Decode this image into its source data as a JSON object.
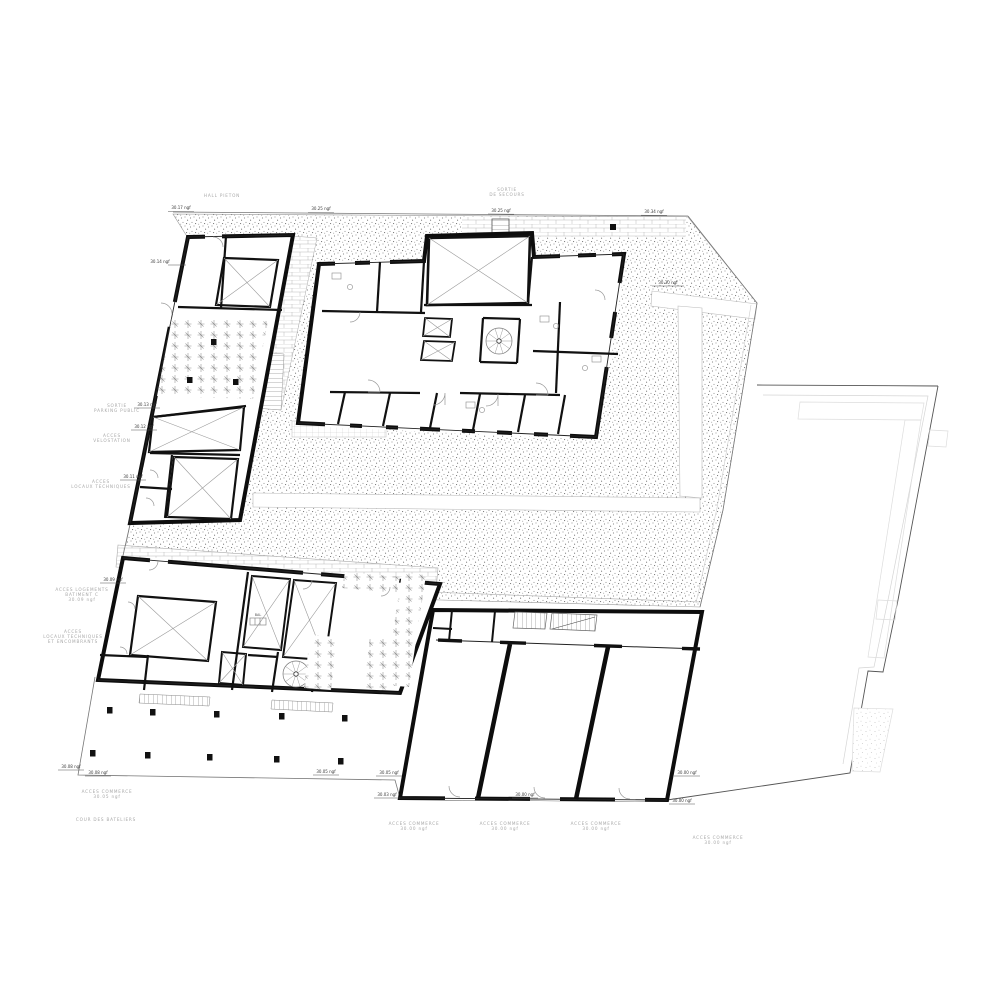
{
  "drawing": {
    "type": "architectural-floor-plan",
    "level": "ground-floor",
    "colors": {
      "wall": "#111111",
      "thin_line": "#888888",
      "light_line": "#cccccc",
      "label_gray": "#a8a8a8",
      "label_black": "#3a3a3a",
      "paper": "#ffffff"
    }
  },
  "labels": {
    "e1": "30.17 ngf",
    "e2": "30.25 ngf",
    "e3": "30.25 ngf",
    "e4": "30.34 ngf",
    "e5": "30.30 ngf",
    "e6": "30.14 ngf",
    "e7": "30.13 ngf",
    "e8": "30.12 ngf",
    "e9": "30.11 ngf",
    "e10": "30.09 ngf",
    "e11": "30.08 ngf",
    "e12": "30.08 ngf",
    "e13": "30.05 ngf",
    "e14": "30.05 ngf",
    "e15": "30.03 ngf",
    "e16": "30.00 ngf",
    "e17": "30.00 ngf",
    "e18": "30.00 ngf",
    "g1": "HALL PIETON",
    "g2a": "SORTIE",
    "g2b": "DE SECOURS",
    "g3a": "SORTIE",
    "g3b": "PARKING PUBLIC",
    "g4a": "ACCES",
    "g4b": "VELOSTATION",
    "g5a": "ACCES",
    "g5b": "LOCAUX TECHNIQUES",
    "g6a": "ACCES LOGEMENTS",
    "g6b": "BATIMENT C",
    "g6c": "30.09 ngf",
    "g7a": "ACCES",
    "g7b": "LOCAUX TECHNIQUES",
    "g7c": "ET ENCOMBRANTS",
    "g8a": "ACCES COMMERCE",
    "g8b": "30.05 ngf",
    "g9": "COUR DES BATELIERS",
    "g10a": "ACCES COMMERCE",
    "g10b": "30.00 ngf",
    "g11a": "ACCES COMMERCE",
    "g11b": "30.00 ngf",
    "g12a": "ACCES COMMERCE",
    "g12b": "30.00 ngf",
    "g13a": "ACCES COMMERCE",
    "g13b": "30.00 ngf",
    "g14": "BAL"
  }
}
